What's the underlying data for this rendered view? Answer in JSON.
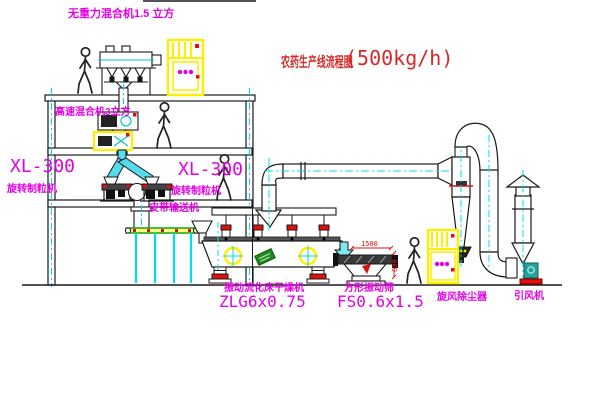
{
  "title": {
    "name": "农药生产线流程图",
    "capacity": "(500kg/h)"
  },
  "labels": {
    "gravity_mixer": "无重力混合机1.5 立方",
    "high_speed_mixer": "高速混合机3立方",
    "granulator_left_model": "XL-300",
    "granulator_left_name": "旋转制粒机",
    "granulator_right_model": "XL-300",
    "granulator_right_name": "旋转制粒机",
    "belt_conveyor": "皮带输送机",
    "dryer_name": "振动流化床干燥机",
    "dryer_model": "ZLG6x0.75",
    "screen_name": "方形振动筛",
    "screen_model": "FS0.6x1.5",
    "cyclone": "旋风除尘器",
    "fan": "引风机"
  },
  "dimensions": {
    "screen_length": "1500",
    "screen_height": "600"
  },
  "colors": {
    "label_magenta": "#e400e4",
    "title_red": "#d42a2a",
    "equipment_yellow": "#ffee00",
    "centerline_cyan": "#00dcec",
    "line_black": "#1a1a1a",
    "status_red": "#e01010",
    "belt_green": "#00a000"
  }
}
